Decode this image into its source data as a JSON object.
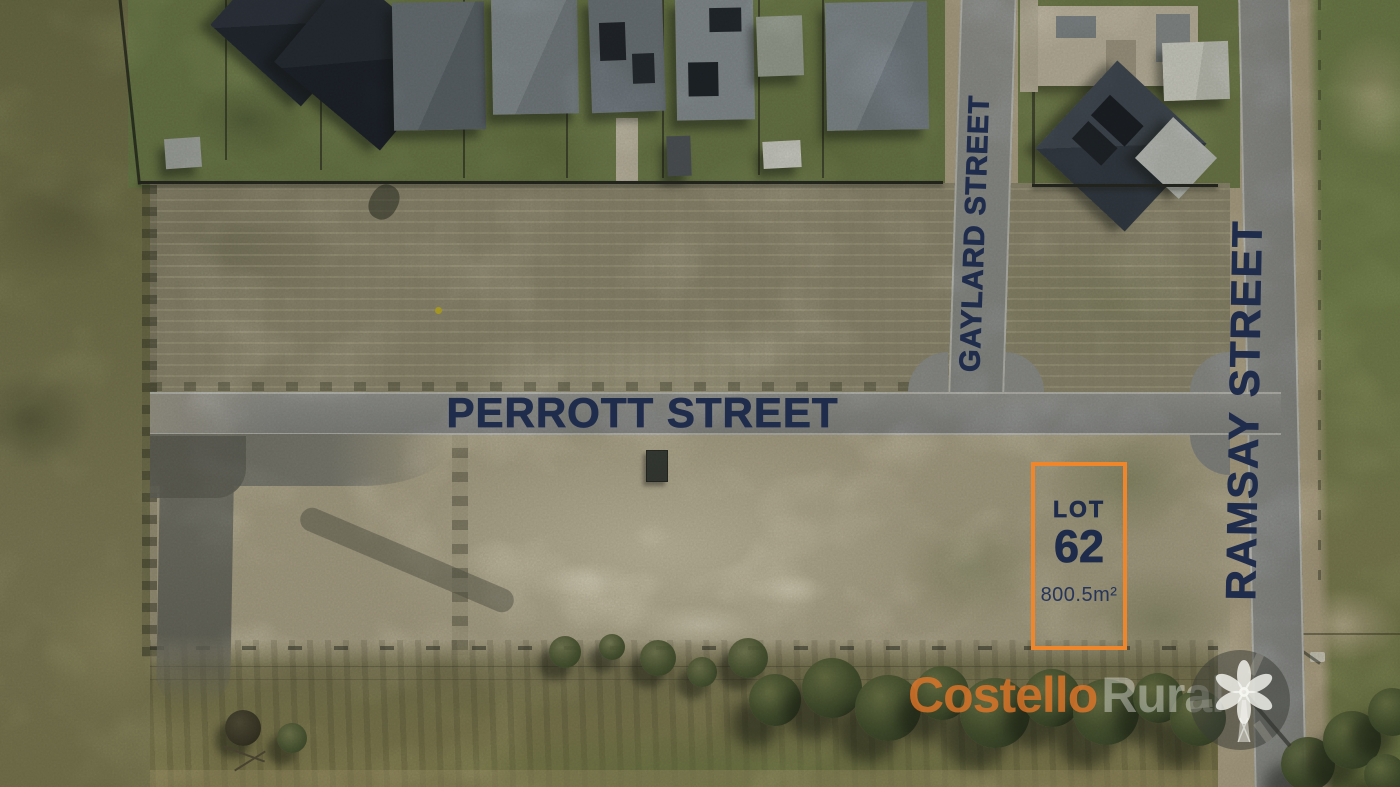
{
  "streets": {
    "perrott": {
      "label": "PERROTT STREET"
    },
    "gaylard": {
      "label": "GAYLARD STREET"
    },
    "ramsay": {
      "label": "RAMSAY STREET"
    }
  },
  "lot": {
    "name": "LOT",
    "number": "62",
    "area": "800.5m²",
    "outline_color": "#F0862B",
    "label_color": "#1E2B4A"
  },
  "watermark": {
    "brand_part1": "Costello",
    "brand_part2": "Rural",
    "icon": "windmill-icon",
    "part1_color": "#E87628",
    "part2_color": "#FAFAF8"
  },
  "palette": {
    "street_label_navy": "#202C4C",
    "road_gray": "#9FA2A5",
    "kerb_white": "#D5D7D8",
    "dirt_light": "#D6CEB6",
    "paddock_olive": "#A39E87",
    "grass_olive": "#8B8A60",
    "tree_green": "#4D5C37",
    "roof_dark": "#2C333F",
    "roof_light": "#98A2AD"
  }
}
